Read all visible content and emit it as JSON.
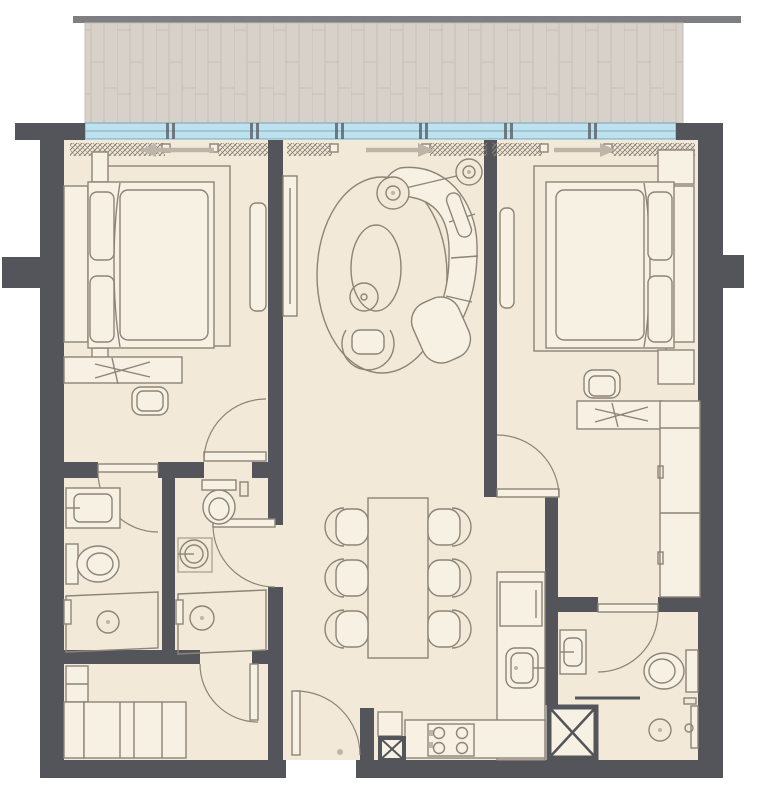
{
  "title": "Two-bedroom apartment floor plan",
  "colors": {
    "wall": "#54555A",
    "floor": "#F2E9D9",
    "floorlight": "#F7F1E4",
    "line": "#8C8476",
    "linesoft": "#B0A894",
    "deck": "#D8D1CA",
    "deckline": "#C6BEB7",
    "glass": "#BEE1EE",
    "glassline": "#7FAEC2",
    "arrow": "#BDB5A8",
    "hatch": "#8A8275",
    "topbar": "#7E7F83"
  },
  "balcony": {
    "id": "balcony",
    "surface": "wood-deck-planks",
    "window_panel_count": 7
  },
  "arrows": [
    {
      "room": "bedroom-left",
      "direction": "left"
    },
    {
      "room": "living-room",
      "direction": "right"
    },
    {
      "room": "bedroom-right",
      "direction": "right"
    }
  ],
  "rooms": [
    {
      "id": "bedroom-left",
      "furniture": [
        "double-bed",
        "headboard",
        "pillows-x2",
        "nightstands-x2",
        "area-rug",
        "desk",
        "desk-chair",
        "wardrobe-panel",
        "curtains",
        "swing-door"
      ]
    },
    {
      "id": "living-room",
      "furniture": [
        "curved-sofa",
        "chaise",
        "oval-coffee-table",
        "round-side-table",
        "armchair",
        "floor-lamps-x2",
        "oval-rug",
        "tv-console",
        "curtains"
      ]
    },
    {
      "id": "dining-area",
      "furniture": [
        "dining-table",
        "dining-chairs-x6",
        "pendant-fixture"
      ]
    },
    {
      "id": "bedroom-right",
      "furniture": [
        "double-bed",
        "headboard",
        "pillows-x2",
        "nightstands-x2",
        "area-rug",
        "desk",
        "desk-chair",
        "wardrobe-3-section",
        "mirror-panel",
        "curtains",
        "swing-door"
      ]
    },
    {
      "id": "bathroom-left",
      "furniture": [
        "vanity-sink",
        "toilet",
        "shower-with-drain",
        "swing-door"
      ]
    },
    {
      "id": "bathroom-ensuite",
      "furniture": [
        "toilet",
        "round-basin",
        "shower-with-drain",
        "swing-door"
      ]
    },
    {
      "id": "bathroom-right",
      "furniture": [
        "vanity-sink",
        "toilet",
        "shower-with-drain",
        "swing-door"
      ]
    },
    {
      "id": "maid-room",
      "furniture": [
        "single-bed",
        "cabinet",
        "swing-door"
      ]
    },
    {
      "id": "kitchen",
      "furniture": [
        "l-shaped-counter",
        "sink",
        "cooktop",
        "fridge"
      ]
    },
    {
      "id": "entrance",
      "furniture": [
        "entry-door",
        "service-shaft"
      ]
    }
  ],
  "dining": {
    "chair_count": 6
  },
  "kitchen": {
    "burner_count": 4
  },
  "shafts": {
    "count": 2
  }
}
